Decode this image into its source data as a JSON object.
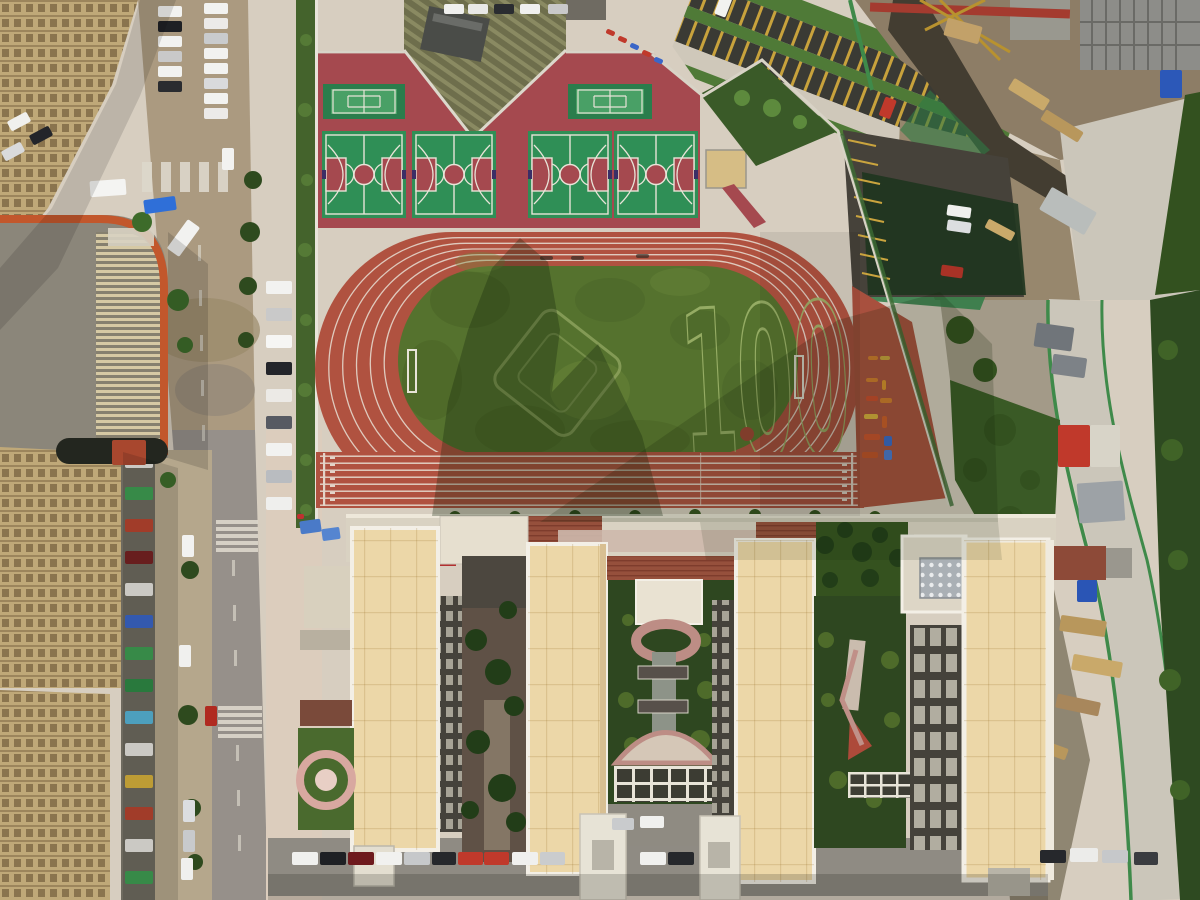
{
  "scene": {
    "field_marking": "100",
    "colors": {
      "concrete": "#d7cec0",
      "plaza": "#dccdbd",
      "street": "#96908a",
      "dirt_road": "#ab9a80",
      "track": "#b05240",
      "track_apron": "#a8503e",
      "grass": "#55722e",
      "grass_marking": "#9db36a",
      "court_base": "#a5494f",
      "court_green": "#2f8f56",
      "tennis_outer": "#2a7d4c",
      "tennis_inner": "#49a066",
      "roof_cream": "#ecd7a8",
      "roof_tile": "#96503c",
      "facade_dark": "#45423b",
      "garden_dark": "#2e4720",
      "hedge": "#44632c",
      "road_light": "#cbc6ba",
      "fence_green": "#3f8a4a",
      "construction_dirt": "#97876d",
      "asphalt": "#8f8b83"
    }
  },
  "objects": {
    "cars_west": [
      {
        "x": 266,
        "y": 281,
        "w": 26,
        "h": 13,
        "c": "#f2f2f0"
      },
      {
        "x": 266,
        "y": 308,
        "w": 26,
        "h": 13,
        "c": "#c9c9c9"
      },
      {
        "x": 266,
        "y": 335,
        "w": 26,
        "h": 13,
        "c": "#f6f6f4"
      },
      {
        "x": 266,
        "y": 362,
        "w": 26,
        "h": 13,
        "c": "#23252a"
      },
      {
        "x": 266,
        "y": 389,
        "w": 26,
        "h": 13,
        "c": "#eceae6"
      },
      {
        "x": 266,
        "y": 416,
        "w": 26,
        "h": 13,
        "c": "#565a62"
      },
      {
        "x": 266,
        "y": 443,
        "w": 26,
        "h": 13,
        "c": "#f2f2f0"
      },
      {
        "x": 266,
        "y": 470,
        "w": 26,
        "h": 13,
        "c": "#b9bcc0"
      },
      {
        "x": 266,
        "y": 497,
        "w": 26,
        "h": 13,
        "c": "#efefed"
      }
    ],
    "cars_south": [
      {
        "x": 292,
        "y": 852,
        "w": 26,
        "h": 13,
        "c": "#f0f0ee"
      },
      {
        "x": 320,
        "y": 852,
        "w": 26,
        "h": 13,
        "c": "#1e2024"
      },
      {
        "x": 348,
        "y": 852,
        "w": 26,
        "h": 13,
        "c": "#6e1a1d"
      },
      {
        "x": 376,
        "y": 852,
        "w": 26,
        "h": 13,
        "c": "#f1f1ef"
      },
      {
        "x": 404,
        "y": 852,
        "w": 26,
        "h": 13,
        "c": "#c6c8ca"
      },
      {
        "x": 432,
        "y": 852,
        "w": 24,
        "h": 13,
        "c": "#26282c"
      },
      {
        "x": 458,
        "y": 852,
        "w": 25,
        "h": 13,
        "c": "#c0392b"
      },
      {
        "x": 484,
        "y": 852,
        "w": 25,
        "h": 13,
        "c": "#c0392b"
      },
      {
        "x": 512,
        "y": 852,
        "w": 26,
        "h": 13,
        "c": "#f0f0ee"
      },
      {
        "x": 540,
        "y": 852,
        "w": 25,
        "h": 13,
        "c": "#caccce"
      },
      {
        "x": 640,
        "y": 852,
        "w": 26,
        "h": 13,
        "c": "#f0f0ee"
      },
      {
        "x": 668,
        "y": 852,
        "w": 26,
        "h": 13,
        "c": "#26282c"
      },
      {
        "x": 1040,
        "y": 850,
        "w": 26,
        "h": 13,
        "c": "#26282c"
      },
      {
        "x": 1070,
        "y": 848,
        "w": 28,
        "h": 14,
        "c": "#ececea"
      },
      {
        "x": 1102,
        "y": 850,
        "w": 26,
        "h": 13,
        "c": "#c6c8ca"
      },
      {
        "x": 1134,
        "y": 852,
        "w": 24,
        "h": 13,
        "c": "#3a3c40"
      }
    ],
    "cars_street_top": [
      {
        "x": 158,
        "y": 6,
        "w": 24,
        "h": 11,
        "c": "#f2f2f0"
      },
      {
        "x": 158,
        "y": 21,
        "w": 24,
        "h": 11,
        "c": "#1e2024"
      },
      {
        "x": 158,
        "y": 36,
        "w": 24,
        "h": 11,
        "c": "#f2f2f0"
      },
      {
        "x": 158,
        "y": 51,
        "w": 24,
        "h": 11,
        "c": "#c9c9c9"
      },
      {
        "x": 158,
        "y": 66,
        "w": 24,
        "h": 11,
        "c": "#f2f2f0"
      },
      {
        "x": 158,
        "y": 81,
        "w": 24,
        "h": 11,
        "c": "#2a2c30"
      },
      {
        "x": 204,
        "y": 3,
        "w": 24,
        "h": 11,
        "c": "#f2f2f0"
      },
      {
        "x": 204,
        "y": 18,
        "w": 24,
        "h": 11,
        "c": "#eceae8"
      },
      {
        "x": 204,
        "y": 33,
        "w": 24,
        "h": 11,
        "c": "#c9cbcd"
      },
      {
        "x": 204,
        "y": 48,
        "w": 24,
        "h": 11,
        "c": "#f2f2f0"
      },
      {
        "x": 204,
        "y": 63,
        "w": 24,
        "h": 11,
        "c": "#f2f2f0"
      },
      {
        "x": 204,
        "y": 78,
        "w": 24,
        "h": 11,
        "c": "#d9dadc"
      },
      {
        "x": 204,
        "y": 93,
        "w": 24,
        "h": 11,
        "c": "#f2f2f0"
      },
      {
        "x": 204,
        "y": 108,
        "w": 24,
        "h": 11,
        "c": "#eceae8"
      },
      {
        "x": 8,
        "y": 116,
        "w": 22,
        "h": 11,
        "c": "#f0f0ee",
        "r": -28
      },
      {
        "x": 30,
        "y": 130,
        "w": 22,
        "h": 11,
        "c": "#23252a",
        "r": -28
      },
      {
        "x": 2,
        "y": 146,
        "w": 22,
        "h": 11,
        "c": "#d9dadc",
        "r": -28
      }
    ],
    "cars_street_bottom": [
      {
        "x": 182,
        "y": 535,
        "w": 12,
        "h": 22,
        "c": "#f2f2f0"
      },
      {
        "x": 179,
        "y": 645,
        "w": 12,
        "h": 22,
        "c": "#f0f0ee"
      },
      {
        "x": 183,
        "y": 800,
        "w": 12,
        "h": 22,
        "c": "#dcdee0"
      },
      {
        "x": 183,
        "y": 830,
        "w": 12,
        "h": 22,
        "c": "#c8cacc"
      },
      {
        "x": 181,
        "y": 858,
        "w": 12,
        "h": 22,
        "c": "#f0f0ee"
      },
      {
        "x": 205,
        "y": 706,
        "w": 12,
        "h": 20,
        "c": "#b02a20"
      },
      {
        "x": 222,
        "y": 148,
        "w": 12,
        "h": 22,
        "c": "#f2f2f0"
      }
    ],
    "cars_top_lot": [
      {
        "x": 444,
        "y": 4,
        "w": 20,
        "h": 10,
        "c": "#f0f0ee"
      },
      {
        "x": 468,
        "y": 4,
        "w": 20,
        "h": 10,
        "c": "#e8e8e6"
      },
      {
        "x": 494,
        "y": 4,
        "w": 20,
        "h": 10,
        "c": "#2a2c30"
      },
      {
        "x": 520,
        "y": 4,
        "w": 20,
        "h": 10,
        "c": "#f0f0ee"
      },
      {
        "x": 548,
        "y": 4,
        "w": 20,
        "h": 10,
        "c": "#c9c9c9"
      }
    ],
    "cars_ne_lot": [
      {
        "x": 947,
        "y": 206,
        "w": 24,
        "h": 11,
        "c": "#f0f0ee",
        "r": 8
      },
      {
        "x": 947,
        "y": 221,
        "w": 24,
        "h": 11,
        "c": "#dcdee0",
        "r": 8
      },
      {
        "x": 941,
        "y": 266,
        "w": 22,
        "h": 11,
        "c": "#a83226",
        "r": 8
      }
    ],
    "cars_courtyard": [
      {
        "x": 640,
        "y": 816,
        "w": 24,
        "h": 12,
        "c": "#f0f0ee"
      },
      {
        "x": 612,
        "y": 818,
        "w": 22,
        "h": 12,
        "c": "#c9cbcd"
      }
    ],
    "large_vehicles": [
      {
        "x": 90,
        "y": 180,
        "w": 36,
        "h": 16,
        "c": "#f4f4f2",
        "r": -4
      },
      {
        "x": 144,
        "y": 198,
        "w": 32,
        "h": 14,
        "c": "#2f6fd8",
        "r": -8
      },
      {
        "x": 176,
        "y": 220,
        "w": 15,
        "h": 36,
        "c": "#f2f2f0",
        "r": 36
      },
      {
        "x": 56,
        "y": 438,
        "w": 112,
        "h": 26,
        "c": "#23261f",
        "rx": 13
      },
      {
        "x": 112,
        "y": 440,
        "w": 34,
        "h": 25,
        "c": "#a8472e"
      }
    ],
    "shop_signs": [
      {
        "x": 125,
        "y": 455,
        "w": 28,
        "h": 13,
        "c": "#e8e6e0"
      },
      {
        "x": 125,
        "y": 487,
        "w": 28,
        "h": 13,
        "c": "#3f9e52"
      },
      {
        "x": 125,
        "y": 519,
        "w": 28,
        "h": 13,
        "c": "#b8442e"
      },
      {
        "x": 125,
        "y": 551,
        "w": 28,
        "h": 13,
        "c": "#772222"
      },
      {
        "x": 125,
        "y": 583,
        "w": 28,
        "h": 13,
        "c": "#e8e6e0"
      },
      {
        "x": 125,
        "y": 615,
        "w": 28,
        "h": 13,
        "c": "#3a66c8"
      },
      {
        "x": 125,
        "y": 647,
        "w": 28,
        "h": 13,
        "c": "#3f9e52"
      },
      {
        "x": 125,
        "y": 679,
        "w": 28,
        "h": 13,
        "c": "#2f8a46"
      },
      {
        "x": 125,
        "y": 711,
        "w": 28,
        "h": 13,
        "c": "#58b6d8"
      },
      {
        "x": 125,
        "y": 743,
        "w": 28,
        "h": 13,
        "c": "#e8e6e0"
      },
      {
        "x": 125,
        "y": 775,
        "w": 28,
        "h": 13,
        "c": "#d8b23c"
      },
      {
        "x": 125,
        "y": 807,
        "w": 28,
        "h": 13,
        "c": "#b8442e"
      },
      {
        "x": 125,
        "y": 839,
        "w": 28,
        "h": 13,
        "c": "#e8e6e0"
      },
      {
        "x": 125,
        "y": 871,
        "w": 28,
        "h": 13,
        "c": "#3f9e52"
      }
    ],
    "fitness_equipment": [
      {
        "x": 868,
        "y": 356,
        "w": 10,
        "h": 4,
        "c": "#d07b2c"
      },
      {
        "x": 880,
        "y": 356,
        "w": 10,
        "h": 4,
        "c": "#c8a23c"
      },
      {
        "x": 866,
        "y": 378,
        "w": 12,
        "h": 4,
        "c": "#d07b2c"
      },
      {
        "x": 882,
        "y": 380,
        "w": 4,
        "h": 10,
        "c": "#d8902c"
      },
      {
        "x": 866,
        "y": 396,
        "w": 12,
        "h": 5,
        "c": "#c84a2c"
      },
      {
        "x": 880,
        "y": 398,
        "w": 12,
        "h": 5,
        "c": "#d07b2c"
      },
      {
        "x": 864,
        "y": 414,
        "w": 14,
        "h": 5,
        "c": "#d8ae3c"
      },
      {
        "x": 882,
        "y": 416,
        "w": 5,
        "h": 12,
        "c": "#cc5c28"
      },
      {
        "x": 864,
        "y": 434,
        "w": 16,
        "h": 6,
        "c": "#c8502c"
      },
      {
        "x": 884,
        "y": 436,
        "w": 8,
        "h": 10,
        "c": "#3a68c8"
      },
      {
        "x": 884,
        "y": 450,
        "w": 8,
        "h": 10,
        "c": "#4a78d0"
      },
      {
        "x": 862,
        "y": 452,
        "w": 16,
        "h": 6,
        "c": "#c05028"
      }
    ],
    "construction_materials": [
      {
        "x": 1008,
        "y": 88,
        "w": 42,
        "h": 13,
        "c": "#c9a96a",
        "r": 32
      },
      {
        "x": 1040,
        "y": 120,
        "w": 44,
        "h": 12,
        "c": "#b8975c",
        "r": 32
      },
      {
        "x": 985,
        "y": 225,
        "w": 30,
        "h": 10,
        "c": "#c9a96a",
        "r": 28
      },
      {
        "x": 1042,
        "y": 198,
        "w": 52,
        "h": 26,
        "c": "#b9bdbb",
        "r": 30
      },
      {
        "x": 1035,
        "y": 325,
        "w": 38,
        "h": 24,
        "c": "#70757a",
        "r": 8
      },
      {
        "x": 1052,
        "y": 356,
        "w": 34,
        "h": 20,
        "c": "#7d8287",
        "r": 8
      },
      {
        "x": 1058,
        "y": 425,
        "w": 32,
        "h": 42,
        "c": "#c0392b"
      },
      {
        "x": 1090,
        "y": 425,
        "w": 30,
        "h": 42,
        "c": "#d8d4c8"
      },
      {
        "x": 1078,
        "y": 482,
        "w": 46,
        "h": 40,
        "c": "#9da2a6",
        "r": -4
      },
      {
        "x": 1060,
        "y": 618,
        "w": 46,
        "h": 16,
        "c": "#b8975c",
        "r": 8
      },
      {
        "x": 1072,
        "y": 658,
        "w": 50,
        "h": 16,
        "c": "#c9a96a",
        "r": 10
      },
      {
        "x": 1056,
        "y": 698,
        "w": 44,
        "h": 14,
        "c": "#a8875c",
        "r": 12
      },
      {
        "x": 1028,
        "y": 742,
        "w": 40,
        "h": 12,
        "c": "#b8975c",
        "r": 20
      },
      {
        "x": 1002,
        "y": 788,
        "w": 30,
        "h": 10,
        "c": "#d8d5c8",
        "r": 40
      },
      {
        "x": 1016,
        "y": 828,
        "w": 26,
        "h": 9,
        "c": "#cfccc0",
        "r": 35
      },
      {
        "x": 988,
        "y": 852,
        "w": 30,
        "h": 10,
        "c": "#d8d5c8",
        "r": 30
      },
      {
        "x": 1160,
        "y": 70,
        "w": 22,
        "h": 28,
        "c": "#2c58b8"
      },
      {
        "x": 1077,
        "y": 580,
        "w": 20,
        "h": 22,
        "c": "#2a55b5"
      },
      {
        "x": 945,
        "y": 22,
        "w": 36,
        "h": 18,
        "c": "#c2a169",
        "r": 15
      }
    ],
    "bike_shed_items": [
      {
        "x": 606,
        "y": 30,
        "w": 9,
        "h": 5,
        "c": "#c0392b",
        "r": 24
      },
      {
        "x": 618,
        "y": 37,
        "w": 9,
        "h": 5,
        "c": "#c0392b",
        "r": 24
      },
      {
        "x": 630,
        "y": 44,
        "w": 9,
        "h": 5,
        "c": "#3a66c8",
        "r": 24
      },
      {
        "x": 642,
        "y": 51,
        "w": 9,
        "h": 5,
        "c": "#c0392b",
        "r": 24
      },
      {
        "x": 654,
        "y": 58,
        "w": 9,
        "h": 5,
        "c": "#3a66c8",
        "r": 24
      }
    ],
    "track_hurdles": [
      {
        "x": 540,
        "y": 256,
        "w": 13,
        "h": 4,
        "c": "#2e2a24",
        "o": 0.65
      },
      {
        "x": 571,
        "y": 256,
        "w": 13,
        "h": 4,
        "c": "#2e2a24",
        "o": 0.65
      },
      {
        "x": 636,
        "y": 254,
        "w": 13,
        "h": 4,
        "c": "#2e2a24",
        "o": 0.65
      }
    ],
    "canopy_tents": [
      {
        "x": 300,
        "y": 520,
        "w": 21,
        "h": 13,
        "c": "#4a7ac8",
        "r": -8
      },
      {
        "x": 322,
        "y": 528,
        "w": 18,
        "h": 12,
        "c": "#5585d0",
        "r": -8
      },
      {
        "x": 297,
        "y": 514,
        "w": 7,
        "h": 5,
        "c": "#c03030"
      }
    ]
  }
}
